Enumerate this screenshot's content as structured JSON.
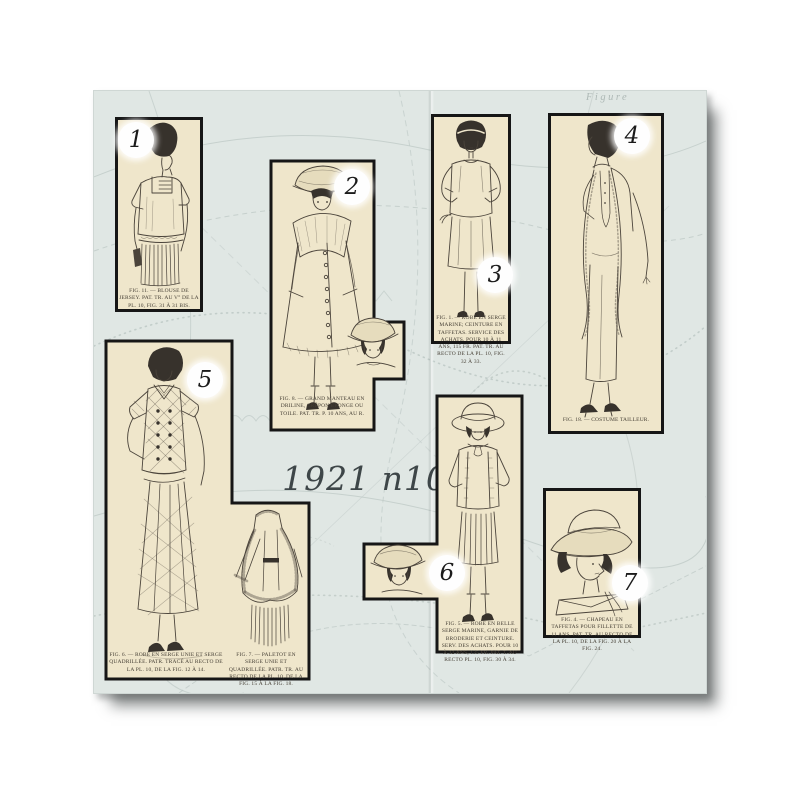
{
  "page": {
    "title": "1921 n10",
    "watermark": "Figure"
  },
  "colors": {
    "canvas": "#ffffff",
    "sheet": "#e0e7e4",
    "pattern_line": "#bfcac7",
    "panel_paper": "#efe6cb",
    "panel_border": "#161616",
    "ink": "#4b443b",
    "title_ink": "#3e4648"
  },
  "panels": [
    {
      "number": "1",
      "caption": "FIG. 11. — BLOUSE DE JERSEY. PAT. TR. AU V° DE LA PL. 10, FIG. 31 À 31 BIS."
    },
    {
      "number": "2",
      "caption": "FIG. 8. — GRAND MANTEAU EN DRILINE, CRÊPON ÉPONGE OU TOILE. PAT. TR. P. 10 ANS, AU R."
    },
    {
      "number": "3",
      "caption": "FIG. 1. — ROBE EN SERGE MARINE; CEINTURE EN TAFFETAS. SERVICE DES ACHATS. POUR 10 À 11 ANS, 115 FR. PAT. TR. AU RECTO DE LA PL. 10, FIG. 32 À 33."
    },
    {
      "number": "4",
      "caption": "FIG. 18. — COSTUME TAILLEUR."
    },
    {
      "number": "5",
      "caption_left": "FIG. 6. — ROBE EN SERGE UNIE ET SERGE QUADRILLÉE. PATR. TRACÉ AU RECTO DE LA PL. 10, DE LA FIG. 12 À 14.",
      "caption_right": "FIG. 7. — PALETOT EN SERGE UNIE ET QUADRILLÉE. PATR. TR. AU RECTO DE LA PL. 10, DE LA FIG. 15 À LA FIG. 18."
    },
    {
      "number": "6",
      "caption": "FIG. 5. — ROBE EN BELLE SERGE MARINE, GARNIE DE BRODERIE ET CEINTURE. SERV. DES ACHATS. POUR 10 À 12 ANS, 135 FR. PAT. T. AU RECTO PL. 10, FIG. 30 À 34."
    },
    {
      "number": "7",
      "caption": "FIG. 4. — CHAPEAU EN TAFFETAS POUR FILLETTE DE 11 ANS. PAT. TR. AU RECTO DE LA PL. 10, DE LA FIG. 20 À LA FIG. 24."
    }
  ]
}
